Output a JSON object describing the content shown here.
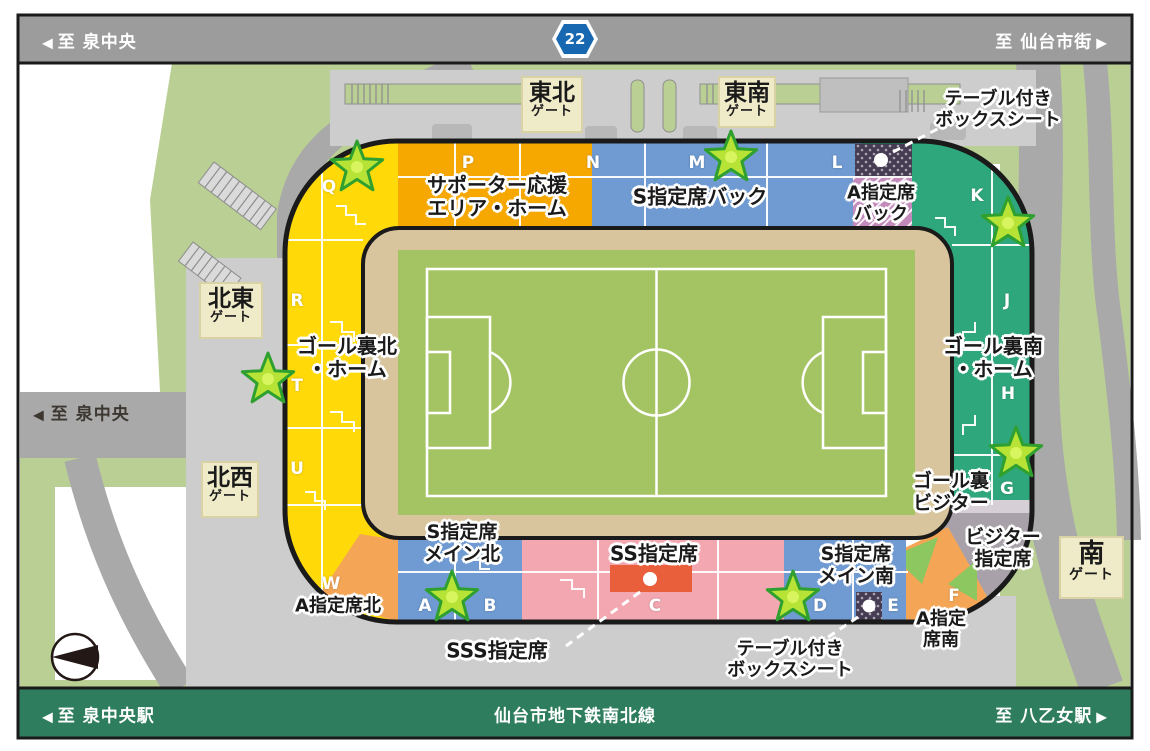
{
  "roads": {
    "top": {
      "left": "至 泉中央",
      "right": "至 仙台市街",
      "route_number": "22"
    },
    "left": {
      "label": "至 泉中央"
    },
    "bottom": {
      "left": "至 泉中央駅",
      "center": "仙台市地下鉄南北線",
      "right": "至 八乙女駅"
    }
  },
  "icons": {
    "arrow_left": "◀",
    "arrow_right": "▶"
  },
  "gates": {
    "tohoku": {
      "name": "東北",
      "suffix": "ゲート"
    },
    "tonan": {
      "name": "東南",
      "suffix": "ゲート"
    },
    "hokuto": {
      "name": "北東",
      "suffix": "ゲート"
    },
    "hokusei": {
      "name": "北西",
      "suffix": "ゲート"
    },
    "minami": {
      "name": "南",
      "suffix": "ゲート"
    }
  },
  "letters": {
    "A": "A",
    "B": "B",
    "C": "C",
    "D": "D",
    "E": "E",
    "F": "F",
    "G": "G",
    "H": "H",
    "J": "J",
    "K": "K",
    "L": "L",
    "M": "M",
    "N": "N",
    "P": "P",
    "Q": "Q",
    "R": "R",
    "T": "T",
    "U": "U",
    "W": "W"
  },
  "areas": {
    "supporter_home": {
      "line1": "サポーター応援",
      "line2": "エリア・ホーム"
    },
    "s_back": {
      "line1": "S指定席バック"
    },
    "a_back": {
      "line1": "A指定席",
      "line2": "バック"
    },
    "box_seat_top": {
      "line1": "テーブル付き",
      "line2": "ボックスシート"
    },
    "goal_south_home": {
      "line1": "ゴール裏南",
      "line2": "・ホーム"
    },
    "goal_visitor": {
      "line1": "ゴール裏",
      "line2": "ビジター"
    },
    "visitor_reserved": {
      "line1": "ビジター",
      "line2": "指定席"
    },
    "a_south": {
      "line1": "A指定",
      "line2": "席南"
    },
    "s_main_south": {
      "line1": "S指定席",
      "line2": "メイン南"
    },
    "box_seat_bottom": {
      "line1": "テーブル付き",
      "line2": "ボックスシート"
    },
    "ss_reserved": {
      "line1": "SS指定席"
    },
    "sss_reserved": {
      "line1": "SSS指定席"
    },
    "s_main_north": {
      "line1": "S指定席",
      "line2": "メイン北"
    },
    "a_north": {
      "line1": "A指定席北"
    },
    "goal_north_home": {
      "line1": "ゴール裏北",
      "line2": "・ホーム"
    }
  },
  "colors": {
    "road_bar": "#9C9C9C",
    "rail_bar": "#2F7D5F",
    "route_shield_blue": "#1768B1",
    "park_green": "#BACF94",
    "road_gray": "#A9A9A9",
    "plaza_gray": "#CDCDCD",
    "structure_gray": "#BFBFBF",
    "stand_yellow": "#FFD908",
    "stand_orange": "#F6A800",
    "stand_blue": "#6F9BD2",
    "stand_purple": "#C289BA",
    "stand_dark_box": "#453B52",
    "stand_green": "#2FA77D",
    "stand_gray": "#A8A1A9",
    "stand_pink": "#F3A8B1",
    "stand_red": "#E95F3C",
    "stand_visitor_orange": "#F4A656",
    "wedge_green": "#8CC75F",
    "track_tan": "#D9C59D",
    "pitch_green": "#A4C464",
    "gate_box_bg": "#EFEAC8",
    "gate_box_border": "#D9D2A4",
    "star_fill": "#B6E335",
    "star_stroke": "#2FA02F",
    "label_dark": "#3D3731"
  }
}
